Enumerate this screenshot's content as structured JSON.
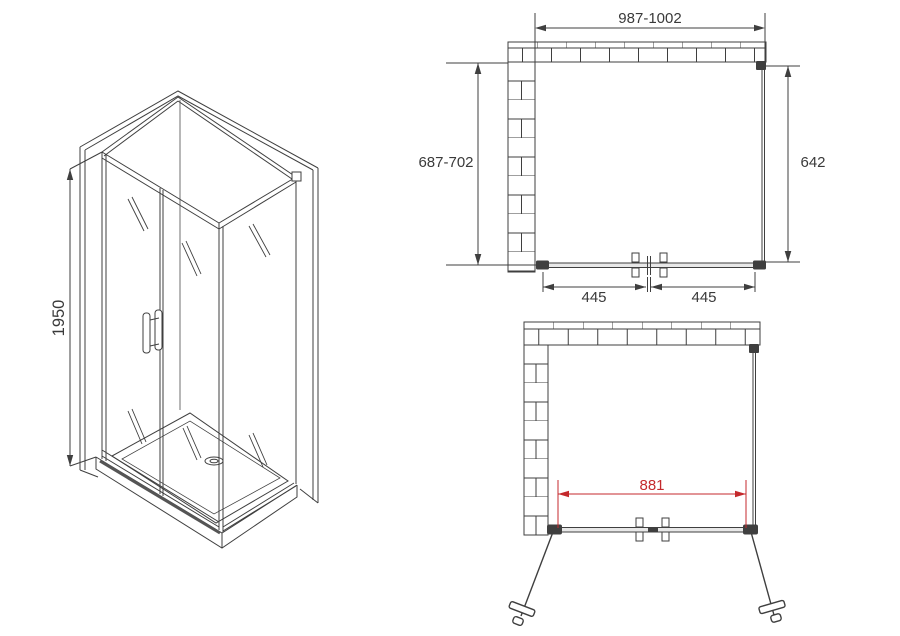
{
  "drawing": {
    "subject": "corner shower enclosure technical drawing",
    "background_color": "#ffffff",
    "line_color": "#3f3f3f",
    "accent_color": "#c4292c",
    "isometric_view": {
      "height": "1950"
    },
    "top_plan_view": {
      "overall_width": "987-1002",
      "overall_depth": "687-702",
      "side_panel": "642",
      "door_left": "445",
      "door_right": "445"
    },
    "front_plan_view": {
      "opening_width": "881"
    }
  }
}
